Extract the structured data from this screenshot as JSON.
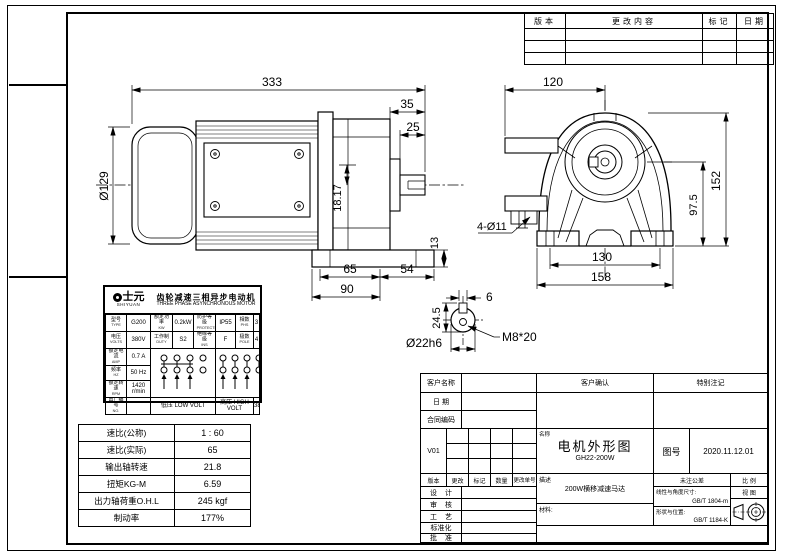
{
  "revision_table": {
    "headers": [
      "版本",
      "更改内容",
      "标记",
      "日期"
    ]
  },
  "dims": {
    "side": {
      "overall_length": "333",
      "shaft_to_face": "35",
      "shaft_length": "25",
      "motor_dia": "Ø129",
      "input_offset": "18.17",
      "foot_thickness": "13",
      "foot_span": "65",
      "face_overhang": "54",
      "base_length": "90"
    },
    "front": {
      "center_offset": "120",
      "height": "152",
      "shaft_center_height": "97.5",
      "mount_holes": "4-Ø11",
      "bolt_spacing": "130",
      "base_width": "158"
    },
    "shaft": {
      "key_width": "6",
      "key_depth": "24.5",
      "tap_hole": "M8*20",
      "shaft_dia": "Ø22h6"
    }
  },
  "nameplate": {
    "brand": "士元",
    "brand_en": "SHIYUAN",
    "title_cn": "齿轮减速三相异步电动机",
    "title_en": "THREE PHASE ASYNCHRONOUS MOTOR",
    "model_label": "型号",
    "model_sub": "TYPE",
    "model": "G200",
    "power_label": "额定功率",
    "power_sub": "KW",
    "power": "0.2kW",
    "protect_label": "防护等级",
    "protect_sub": "PROTECTION",
    "protect": "IP55",
    "phase_label": "相数",
    "phase_sub": "PHS",
    "phase": "3",
    "volt_label": "电压",
    "volt_sub": "VOLTS",
    "volt": "380V",
    "duty_label": "工作制",
    "duty_sub": "DUTY",
    "duty": "S2",
    "ins_label": "绝缘等级",
    "ins_sub": "INS",
    "ins": "F",
    "pole_label": "极数",
    "pole_sub": "POLE",
    "pole": "4",
    "amp_label": "额定电流",
    "amp_sub": "AMP",
    "amp": "0.7 A",
    "freq_label": "频率",
    "freq_sub": "HZ",
    "freq": "50 Hz",
    "speed_label": "额定转速",
    "speed_sub": "RPM",
    "speed": "1420 r/min",
    "serial_label": "出厂编号",
    "serial_sub": "NO.",
    "low_volt_cn": "低压",
    "low_volt_en": "LOW VOLT",
    "high_volt_cn": "高压",
    "high_volt_en": "HIGH VOLT",
    "high_volt_val": "380V"
  },
  "spec_table": {
    "rows": [
      {
        "label": "速比(公称)",
        "value": "1 : 60"
      },
      {
        "label": "速比(实际)",
        "value": "65"
      },
      {
        "label": "输出轴转速",
        "value": "21.8"
      },
      {
        "label": "扭矩KG-M",
        "value": "6.59"
      },
      {
        "label": "出力轴荷重O.H.L",
        "value": "245  kgf"
      },
      {
        "label": "制动率",
        "value": "177%"
      }
    ]
  },
  "title_block": {
    "customer_label": "客户名称",
    "date_label": "日 期",
    "contract_label": "合同编码",
    "confirm_label": "客户确认",
    "note_label": "特别注记",
    "version": "V01",
    "rev_headers": [
      "版本",
      "更改",
      "标记",
      "数量",
      "更改单号"
    ],
    "name_label": "名称",
    "drawing_title": "电机外形图",
    "model_code": "GH22-200W",
    "fig_label": "图号",
    "fig_number": "2020.11.12.01",
    "desc_label": "描述",
    "description": "200W横移减速马达",
    "material_label": "材料:",
    "tolerance_label": "未注公差",
    "scale_label": "比 例",
    "view_label": "视 图",
    "linear_tol_label": "线性与角度尺寸:",
    "linear_tol_std": "GB/T 1804-m",
    "geo_tol_label": "形状与位置:",
    "geo_tol_std": "GB/T 1184-K",
    "sign_labels": [
      "设 计",
      "审 核",
      "工 艺",
      "标准化",
      "批 准"
    ]
  }
}
